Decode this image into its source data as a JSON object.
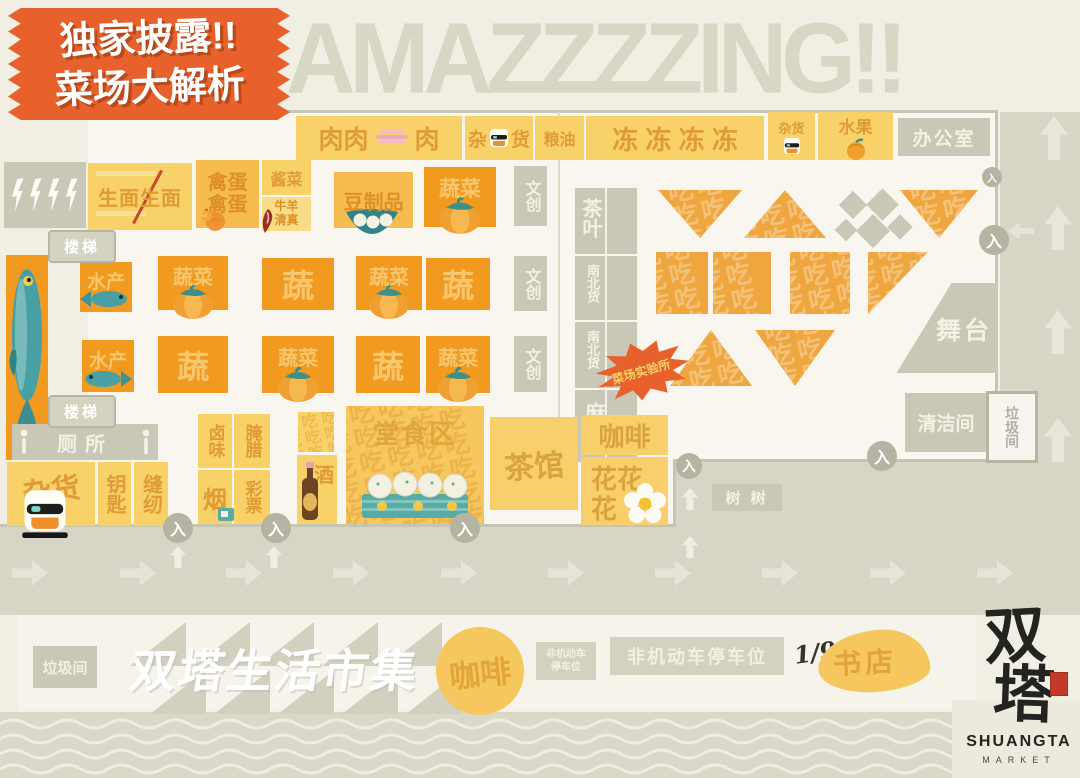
{
  "badge": {
    "line1": "独家披露!!",
    "line2": "菜场大解析"
  },
  "title": "AMAZZZZING!!",
  "entrance_label": "入",
  "decor": {
    "chi_pattern": "吃吃吃吃吃吃吃吃吃吃吃吃吃吃吃吃吃吃吃吃吃吃吃吃吃吃吃吃吃吃吃吃吃吃吃吃吃吃吃吃吃吃吃吃吃吃吃吃"
  },
  "stalls": {
    "meat_a": "肉肉",
    "meat_b": "肉",
    "grocery_a": "杂",
    "grocery_b": "货",
    "grain_oil": "粮油",
    "frozen": "冻 冻 冻 冻",
    "grocery_small": "杂货",
    "fruit": "水果",
    "office": "办公室",
    "noodles": "生面生面",
    "eggs": "禽蛋",
    "pickles": "酱菜",
    "halal_1": "牛羊",
    "halal_2": "清真",
    "tofu": "豆制品",
    "veg": "蔬菜",
    "veg_short": "蔬",
    "cultural": "文创",
    "tea_leaves": "茶叶",
    "nb_goods": "南北货",
    "sesame_oil": "麻油",
    "lab": "菜场实验所",
    "aquatic": "水产",
    "stairs": "楼梯",
    "toilet": "厕所",
    "grocery_corner": "杂货",
    "keys": "钥匙",
    "sewing": "缝纫",
    "braised": "卤味",
    "cured": "腌腊",
    "tobacco": "烟",
    "lottery": "彩票",
    "alcohol": "酒",
    "dining": "堂食区",
    "teahouse": "茶馆",
    "coffee": "咖啡",
    "flowers_1": "花花",
    "flowers_2": "花",
    "stage": "舞台",
    "cleaning": "清洁间",
    "trash": "垃圾间",
    "trees": "树 树"
  },
  "bottom": {
    "trash": "垃圾间",
    "market_title": "双塔生活市集",
    "coffee": "咖啡",
    "parking_small_1": "非机动车",
    "parking_small_2": "停车位",
    "parking_large": "非机动车停车位",
    "fraction": "1/9",
    "bookstore": "书店",
    "logo_char_1": "双",
    "logo_char_2": "塔",
    "logo_name": "SHUANGTA",
    "logo_sub": "MARKET"
  }
}
